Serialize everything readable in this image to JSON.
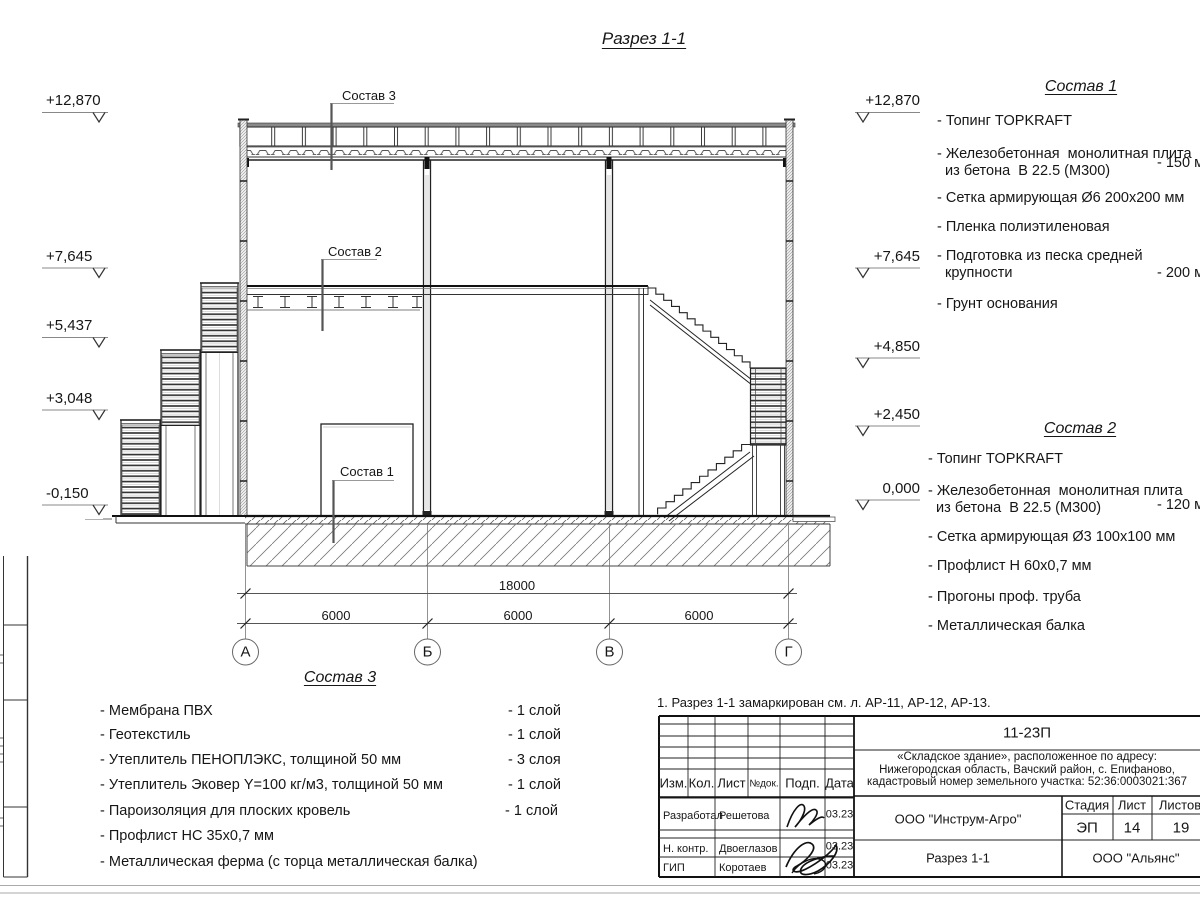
{
  "title": "Разрез 1-1",
  "note": "1. Разрез 1-1 замаркирован см. л. АР-11, АР-12, АР-13.",
  "elevations": {
    "left": [
      "+12,870",
      "+7,645",
      "+5,437",
      "+3,048",
      "-0,150"
    ],
    "right": [
      "+12,870",
      "+7,645",
      "+4,850",
      "+2,450",
      "0,000"
    ]
  },
  "dimensions": {
    "total": "18000",
    "spans": [
      "6000",
      "6000",
      "6000"
    ]
  },
  "axes": [
    "А",
    "Б",
    "В",
    "Г"
  ],
  "sostav1": {
    "title": "Состав 1",
    "items": [
      {
        "text": "- Топинг TOPKRAFT"
      },
      {
        "text": "- Железобетонная  монолитная плита\n  из бетона  В 22.5 (М300)",
        "value": "- 150 мм"
      },
      {
        "text": "- Сетка армирующая Ø6 200x200 мм"
      },
      {
        "text": "- Пленка полиэтиленовая"
      },
      {
        "text": "- Подготовка из песка средней\n  крупности",
        "value": "- 200 мм"
      },
      {
        "text": "- Грунт основания"
      }
    ]
  },
  "sostav2": {
    "title": "Состав 2",
    "items": [
      {
        "text": "- Топинг TOPKRAFT"
      },
      {
        "text": "- Железобетонная  монолитная плита\n  из бетона  В 22.5 (М300)",
        "value": "- 120 мм"
      },
      {
        "text": "- Сетка армирующая Ø3 100x100 мм"
      },
      {
        "text": "- Профлист Н 60x0,7 мм"
      },
      {
        "text": "- Прогоны проф. труба"
      },
      {
        "text": "- Металлическая балка"
      }
    ]
  },
  "sostav3": {
    "title": "Состав 3",
    "items": [
      {
        "text": "- Мембрана ПВХ",
        "value": "- 1 слой"
      },
      {
        "text": "- Геотекстиль",
        "value": "- 1 слой"
      },
      {
        "text": "- Утеплитель ПЕНОПЛЭКС, толщиной 50 мм",
        "value": "- 3 слоя"
      },
      {
        "text": "- Утеплитель Эковер Y=100 кг/м3, толщиной 50 мм",
        "value": "- 1 слой"
      },
      {
        "text": "- Пароизоляция для плоских кровель",
        "value": "- 1 слой"
      },
      {
        "text": "- Профлист НС 35х0,7 мм"
      },
      {
        "text": "- Металлическая ферма (с торца металлическая балка)"
      }
    ]
  },
  "titleblock": {
    "doc_number": "11-23П",
    "object_lines": [
      "«Складское здание», расположенное по адресу:",
      "Нижегородская область, Вачский район, с. Епифаново,",
      "кадастровый номер земельного участка: 52:36:0003021:367"
    ],
    "header": {
      "izm": "Изм.",
      "kol": "Кол.",
      "list": "Лист",
      "ndok": "№док.",
      "podp": "Подп.",
      "data": "Дата"
    },
    "rows": [
      {
        "role": "Разработал",
        "name": "Решетова",
        "date": "03.23"
      },
      {
        "role": "Н. контр.",
        "name": "Двоеглазов",
        "date": "03.23"
      },
      {
        "role": "ГИП",
        "name": "Коротаев",
        "date": "03.23"
      }
    ],
    "org": "ООО \"Инструм-Агро\"",
    "stage_label": "Стадия",
    "sheet_label": "Лист",
    "sheets_label": "Листов",
    "stage": "ЭП",
    "sheet": "14",
    "sheets": "19",
    "drawing_name": "Разрез 1-1",
    "company": "ООО \"Альянс\""
  }
}
